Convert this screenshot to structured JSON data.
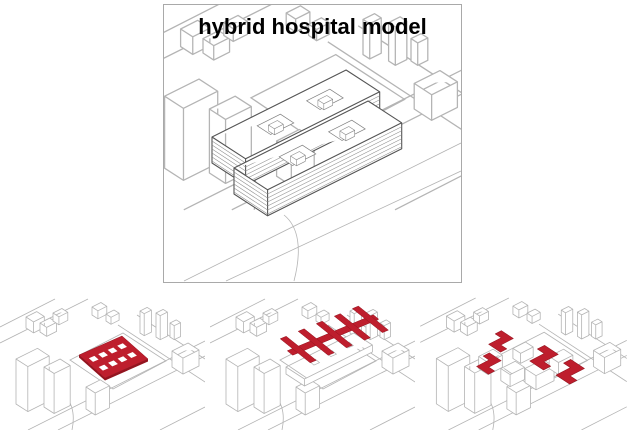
{
  "title": "hybrid hospital model",
  "colors": {
    "accent-red": "#be1e2d",
    "accent-red-dark": "#93141f",
    "line-light": "#b4b4b4",
    "line-dark": "#545454",
    "stripe": "#8f8f8f",
    "panel-border": "#a9a9a9",
    "background": "#ffffff"
  },
  "main_panel": {
    "title": "hybrid hospital model",
    "drawing": "isometric-city-block-with-striped-hybrid-hospital-building"
  },
  "bottom_panels": [
    {
      "drawing": "red-perforated-slab-massing-diagram"
    },
    {
      "drawing": "red-comb-bars-on-podium-massing-diagram"
    },
    {
      "drawing": "red-interlocking-pinwheel-blocks-massing-diagram"
    }
  ]
}
